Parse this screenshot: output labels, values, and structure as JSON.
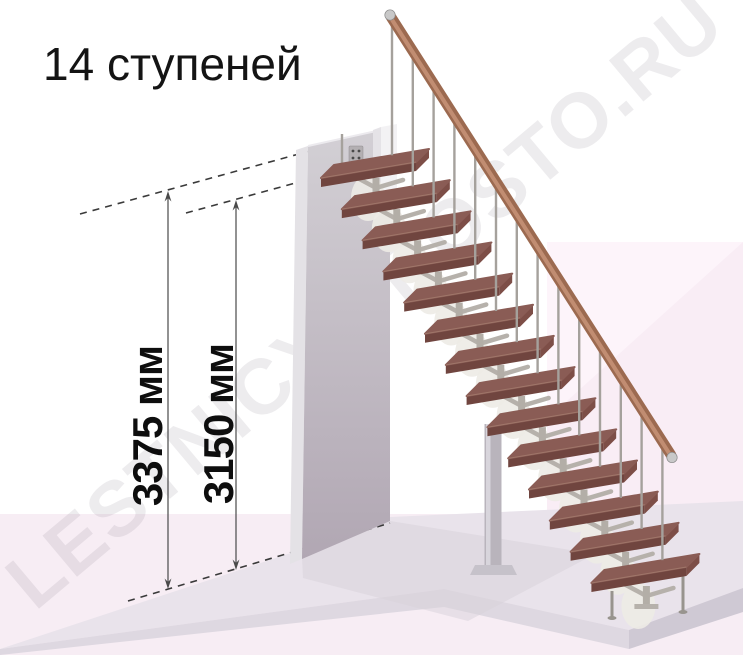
{
  "title": "14 ступеней",
  "watermark": "LESTNICY-PROSTO.RU",
  "dimensions": {
    "overall_height": "3375 мм",
    "floor_to_top_step": "3150 мм"
  },
  "stairs": {
    "steps_count": 14
  },
  "colors": {
    "background": "#ffffff",
    "pink_floor": "#f7edf4",
    "pink_wall": "#f9edf5",
    "pink_wall_light": "#fdf4fa",
    "slab_top": "#e9e3eb",
    "slab_front": "#ded8e1",
    "slab_side": "#cfc9d4",
    "slab_shadow": "#d8d1da",
    "wall_top": "#d3d0d5",
    "wall_bottom": "#b1a7b3",
    "wall_left": "#e4e2e6",
    "wall_top_edge": "#eceaee",
    "white_box_front": "#f3f2f4",
    "white_box_side": "#e5e3e7",
    "plate": "#b3afb2",
    "plate_hole": "#4a4a4a",
    "tread_top": "#8a5c55",
    "tread_front": "#70453f",
    "tread_side": "#7d4e47",
    "tread_edge": "#a57d6f",
    "metal_post": "#b3aea7",
    "metal_arm": "#b6b1ab",
    "flange": "#edebe6",
    "baluster": "#a5a19c",
    "leg": "#98948e",
    "column": "#b9b4bc",
    "column_light": "#d8d5dc",
    "column_base": "#c6c2ca",
    "rail": "#9c6a50",
    "rail_light": "#c69176",
    "rail_cap": "#c8c8c8",
    "dash_line": "#3a3a3a",
    "dim_line": "#4a4a4a",
    "watermark_color": "rgba(125,120,133,0.14)",
    "text": "#141414"
  }
}
